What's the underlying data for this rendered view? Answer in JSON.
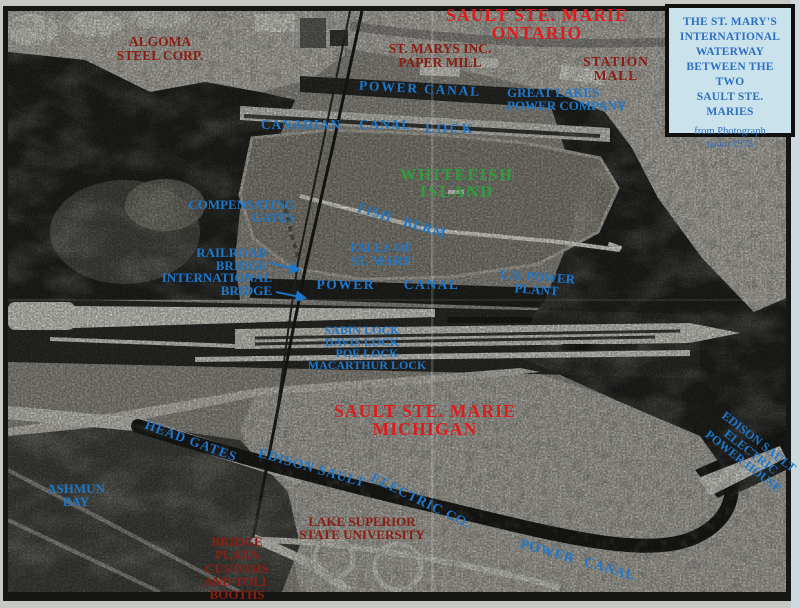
{
  "palette": {
    "label_blue": "#1d78cc",
    "label_red_bright": "#e01b1b",
    "label_red_dark": "#8b1d12",
    "label_green": "#2f9e3c",
    "info_text": "#2e6fc0",
    "info_bg": "#c9e2ec"
  },
  "info_box": {
    "lines": [
      "THE ST. MARY'S",
      "INTERNATIONAL",
      "WATERWAY",
      "BETWEEN THE",
      "TWO",
      "SAULT STE.",
      "MARIES"
    ],
    "subtitle_lines": [
      "from Photograph",
      "taken 1978"
    ]
  },
  "map": {
    "labels": [
      {
        "id": "sault-ste-marie-ontario",
        "lines": [
          "SAULT STE. MARIE",
          "ONTARIO"
        ],
        "color": "red",
        "x": 537,
        "y": 7,
        "align": "center",
        "size": 17.5,
        "ls": 1.2
      },
      {
        "id": "algoma-steel-corp",
        "lines": [
          "ALGOMA",
          "STEEL CORP."
        ],
        "color": "maroon",
        "x": 160,
        "y": 35,
        "align": "center",
        "size": 13.5
      },
      {
        "id": "st-marys-inc-paper-mill",
        "lines": [
          "ST. MARYS INC.",
          "PAPER MILL"
        ],
        "color": "maroon",
        "x": 440,
        "y": 42,
        "align": "center",
        "size": 13.5
      },
      {
        "id": "station-mall",
        "lines": [
          "STATION",
          "MALL"
        ],
        "color": "maroon",
        "x": 616,
        "y": 55,
        "align": "center",
        "size": 13.5,
        "ls": 1
      },
      {
        "id": "power-canal-top",
        "lines": [
          "POWER CANAL"
        ],
        "color": "blue",
        "x": 420,
        "y": 82,
        "align": "center",
        "size": 13.5,
        "ls": 1.8,
        "rot": 3
      },
      {
        "id": "great-lakes-power-company",
        "lines": [
          "GREAT LAKES",
          "POWER COMPANY"
        ],
        "color": "blue",
        "x": 507,
        "y": 86,
        "align": "left",
        "size": 13
      },
      {
        "id": "canadian-canal",
        "lines": [
          "CANADIAN CANAL"
        ],
        "color": "blue",
        "x": 336,
        "y": 118,
        "align": "center",
        "size": 13.5,
        "ls": 0.8,
        "ws": 14
      },
      {
        "id": "lock",
        "lines": [
          "LOCK"
        ],
        "color": "blue",
        "x": 450,
        "y": 122,
        "align": "center",
        "size": 13.5,
        "ls": 2.5
      },
      {
        "id": "whitefish-island",
        "lines": [
          "WHITEFISH",
          "ISLAND"
        ],
        "color": "green",
        "x": 457,
        "y": 167,
        "align": "center",
        "size": 16.5,
        "ls": 2
      },
      {
        "id": "compensating-gates",
        "lines": [
          "COMPENSATING",
          "GATES"
        ],
        "color": "blue",
        "x": 295,
        "y": 198,
        "align": "right",
        "size": 13
      },
      {
        "id": "fish-berm",
        "lines": [
          "FISH BERM"
        ],
        "color": "blue",
        "x": 402,
        "y": 214,
        "align": "center",
        "size": 13.5,
        "ls": 1,
        "ws": 8,
        "rot": 17
      },
      {
        "id": "falls-of-st-mary",
        "lines": [
          "FALLS OF",
          "ST. MARY"
        ],
        "color": "blue",
        "x": 381,
        "y": 241,
        "align": "center",
        "size": 13
      },
      {
        "id": "railroad-bridge",
        "lines": [
          "RAILROAD",
          "BRIDGE"
        ],
        "color": "blue",
        "x": 267,
        "y": 246,
        "align": "right",
        "size": 13
      },
      {
        "id": "international-bridge",
        "lines": [
          "INTERNATIONAL",
          "BRIDGE"
        ],
        "color": "blue",
        "x": 272,
        "y": 271,
        "align": "right",
        "size": 13
      },
      {
        "id": "power-canal-mid",
        "lines": [
          "POWER CANAL"
        ],
        "color": "blue",
        "x": 388,
        "y": 278,
        "align": "center",
        "size": 13.5,
        "ls": 1.5,
        "ws": 24
      },
      {
        "id": "us-power-plant",
        "lines": [
          "U.S. POWER",
          "PLANT"
        ],
        "color": "blue",
        "x": 537,
        "y": 270,
        "align": "center",
        "size": 13,
        "rot": 4
      },
      {
        "id": "sabin-davis-lock",
        "lines": [
          "SABIN LOCK",
          "DAVIS LOCK"
        ],
        "color": "blue",
        "x": 362,
        "y": 324,
        "align": "center",
        "size": 12
      },
      {
        "id": "poe-macarthur-lock",
        "lines": [
          "POE LOCK",
          "MACARTHUR LOCK"
        ],
        "color": "blue",
        "x": 367,
        "y": 347,
        "align": "center",
        "size": 12
      },
      {
        "id": "sault-ste-marie-michigan",
        "lines": [
          "SAULT STE. MARIE",
          "MICHIGAN"
        ],
        "color": "red",
        "x": 425,
        "y": 403,
        "align": "center",
        "size": 17.5,
        "ls": 1.2
      },
      {
        "id": "head-gates",
        "lines": [
          "HEAD GATES"
        ],
        "color": "blue",
        "x": 191,
        "y": 434,
        "align": "center",
        "size": 13.5,
        "ls": 1,
        "rot": 20
      },
      {
        "id": "edison-sault",
        "lines": [
          "EDISON SAULT"
        ],
        "color": "blue",
        "x": 312,
        "y": 461,
        "align": "center",
        "size": 13.5,
        "ls": 1,
        "rot": 16
      },
      {
        "id": "ashmun-bay",
        "lines": [
          "ASHMUN",
          "BAY"
        ],
        "color": "blue",
        "x": 76,
        "y": 482,
        "align": "center",
        "size": 13
      },
      {
        "id": "electric-co",
        "lines": [
          "ELECTRIC CO."
        ],
        "color": "blue",
        "x": 421,
        "y": 494,
        "align": "center",
        "size": 13.5,
        "ls": 1,
        "rot": 26
      },
      {
        "id": "lake-superior-state-university",
        "lines": [
          "LAKE SUPERIOR",
          "STATE UNIVERSITY"
        ],
        "color": "maroon",
        "x": 362,
        "y": 515,
        "align": "center",
        "size": 13
      },
      {
        "id": "bridge-plaza-customs",
        "lines": [
          "BRIDGE",
          "PLAZA",
          "CUSTOMS",
          "AND TOLL",
          "BOOTHS"
        ],
        "color": "maroon",
        "x": 237,
        "y": 535,
        "align": "center",
        "size": 13
      },
      {
        "id": "power-canal-bottom",
        "lines": [
          "POWER CANAL"
        ],
        "color": "blue",
        "x": 578,
        "y": 553,
        "align": "center",
        "size": 13.5,
        "ls": 1,
        "ws": 6,
        "rot": 16
      },
      {
        "id": "edison-sault-power-house",
        "lines": [
          "EDISON SAULT",
          "ELECTRIC",
          "POWER HOUSE"
        ],
        "color": "blue",
        "x": 751,
        "y": 433,
        "align": "center",
        "size": 12.3,
        "rot": 38
      }
    ]
  }
}
